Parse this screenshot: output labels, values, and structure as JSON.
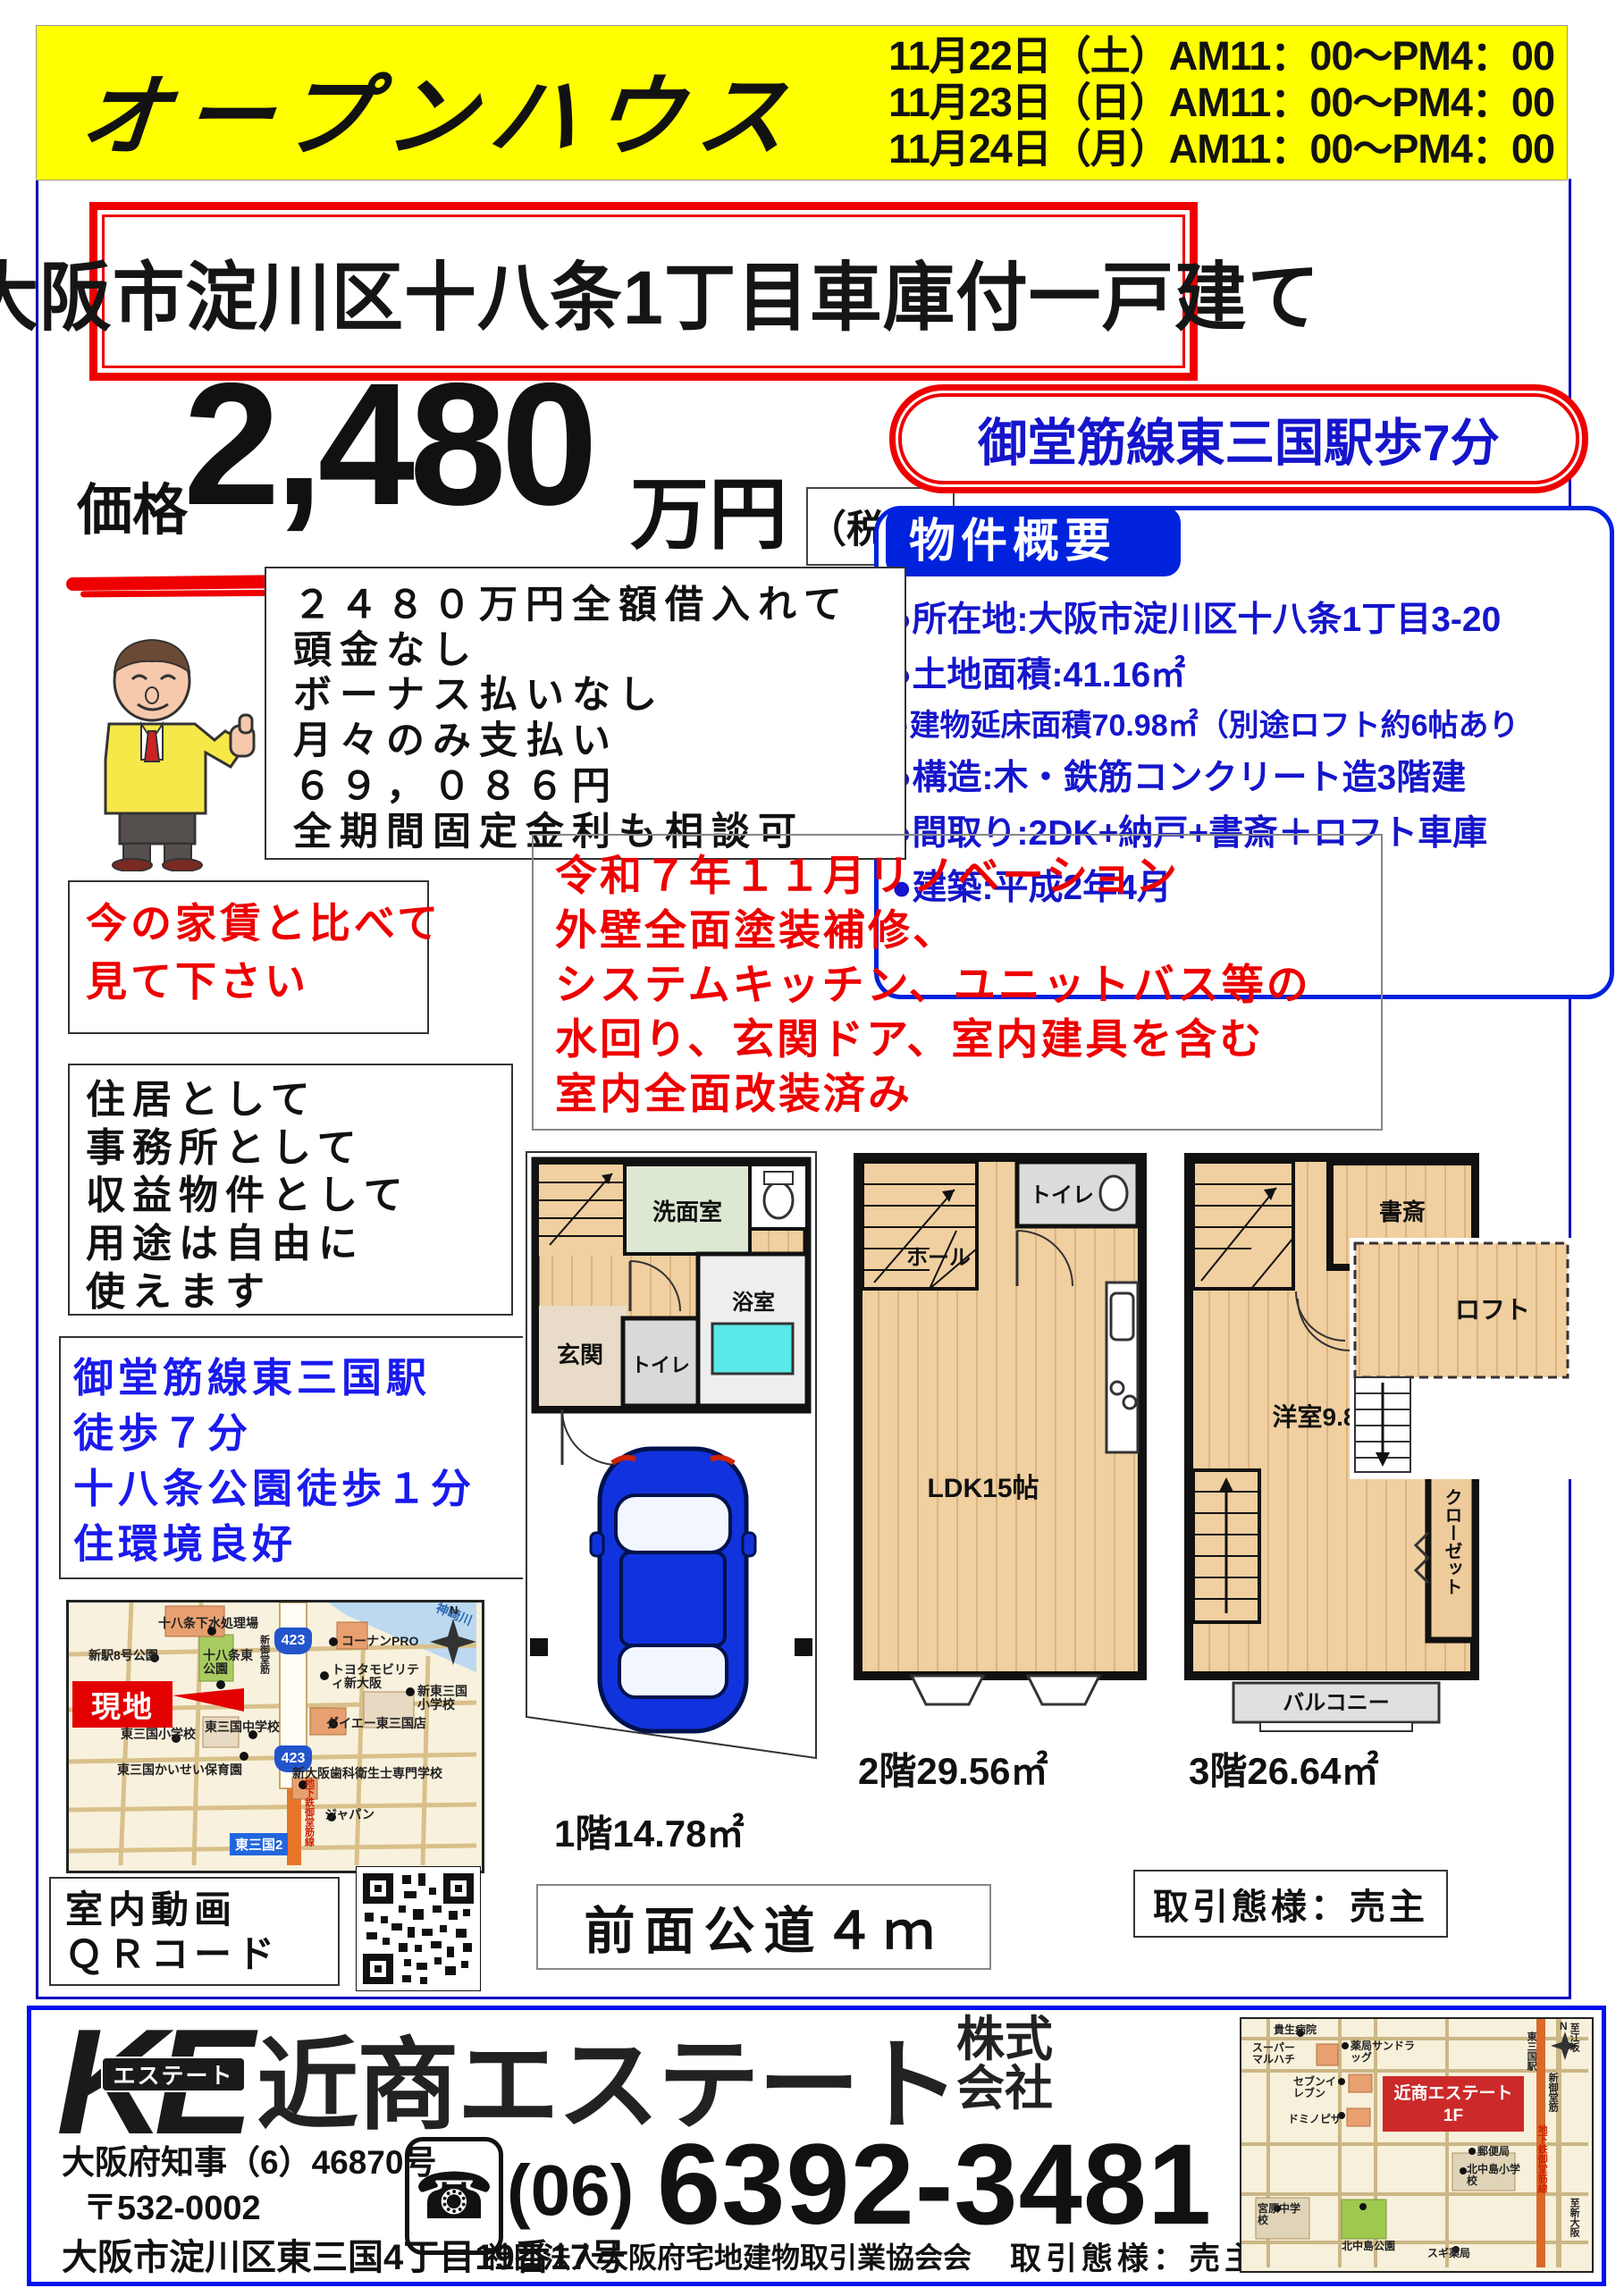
{
  "banner": {
    "title": "オープンハウス",
    "dates": [
      "11月22日（土）AM11：00～PM4：00",
      "11月23日（日）AM11：00～PM4：00",
      "11月24日（月）AM11：00～PM4：00"
    ]
  },
  "main_title": "大阪市淀川区十八条1丁目車庫付一戸建て",
  "price": {
    "label": "価格",
    "amount": "2,480",
    "unit": "万円",
    "tax_note": "（税込）"
  },
  "station_badge": "御堂筋線東三国駅歩7分",
  "overview": {
    "header": "物件概要",
    "items": [
      "●所在地:大阪市淀川区十八条1丁目3-20",
      "●土地面積:41.16㎡",
      "●建物延床面積70.98㎡（別途ロフト約6帖あり",
      "●構造:木・鉄筋コンクリート造3階建",
      "●間取り:2DK+納戸+書斎＋ロフト車庫",
      "●建築:平成2年4月"
    ]
  },
  "loan": {
    "lines": [
      "２４８０万円全額借入れて",
      "頭金なし",
      "ボーナス払いなし",
      "月々のみ支払い",
      "６９，０８６円",
      "全期間固定金利も相談可"
    ]
  },
  "rent_compare": {
    "lines": [
      "今の家賃と比べて",
      "見て下さい"
    ]
  },
  "usage": {
    "lines": [
      "住居として",
      "事務所として",
      "収益物件として",
      "用途は自由に",
      "使えます"
    ]
  },
  "access": {
    "lines": [
      "御堂筋線東三国駅",
      "徒歩７分",
      "十八条公園徒歩１分",
      "住環境良好"
    ]
  },
  "area_map": {
    "site": "現地",
    "river": "神崎川",
    "route_badge": "423",
    "station_sign": "東三国2",
    "road_vertical": "新御堂筋",
    "subway_vertical": "地下鉄御堂筋線",
    "compass": "N",
    "labels": [
      "十八条下水処理場",
      "新駅8号公園",
      "十八条東公園",
      "コーナンPRO",
      "トヨタモビリティ新大阪",
      "新東三国小学校",
      "ダイエー東三国店",
      "東三国小学校",
      "東三国中学校",
      "東三国かいせい保育園",
      "新大阪歯科衛生士専門学校",
      "ジャパン"
    ]
  },
  "qr_section": {
    "lines": [
      "室内動画",
      "ＱＲコード"
    ]
  },
  "floorplans": {
    "f1": {
      "washroom": "洗面室",
      "entrance": "玄関",
      "toilet": "トイレ",
      "bath": "浴室",
      "area": "1階14.78㎡"
    },
    "f2": {
      "toilet": "トイレ",
      "hall": "ホール",
      "ldk": "LDK15帖",
      "area": "2階29.56㎡"
    },
    "f3": {
      "study": "書斎",
      "bedroom": "洋室9.8帖",
      "closet1": "クローゼット",
      "closet2": "クローゼット",
      "balcony": "バルコニー",
      "area": "3階26.64㎡"
    },
    "loft": {
      "label": "ロフト"
    }
  },
  "road_note": "前面公道４ｍ",
  "deal_type": "取引態様：売主",
  "footer": {
    "logo_letters": "KE",
    "logo_sub": "エステート",
    "company": "近商エステート",
    "company_suffix1": "株式",
    "company_suffix2": "会社",
    "license": "大阪府知事（6）46870号",
    "postal": "〒532-0002",
    "address": "大阪市淀川区東三国4丁目19番17号",
    "phone_area": "(06)",
    "phone_number": "6392-3481",
    "association": "社団法人大阪府宅地建物取引業協会会",
    "deal_type": "取引態様：売主",
    "map": {
      "office_line1": "近商エステート",
      "office_line2": "1F",
      "compass": "N",
      "labels": [
        "貴生病院",
        "スーパーマルハチ",
        "薬局サンドラッグ",
        "セブンイレブン",
        "ドミノピザ",
        "郵便局",
        "北中島小学校",
        "宮原中学校",
        "北中島公園",
        "スギ薬局"
      ],
      "v_labels": [
        "至江坂",
        "東三国駅",
        "新御堂筋",
        "地下鉄御堂筋線",
        "至新大阪"
      ]
    }
  }
}
